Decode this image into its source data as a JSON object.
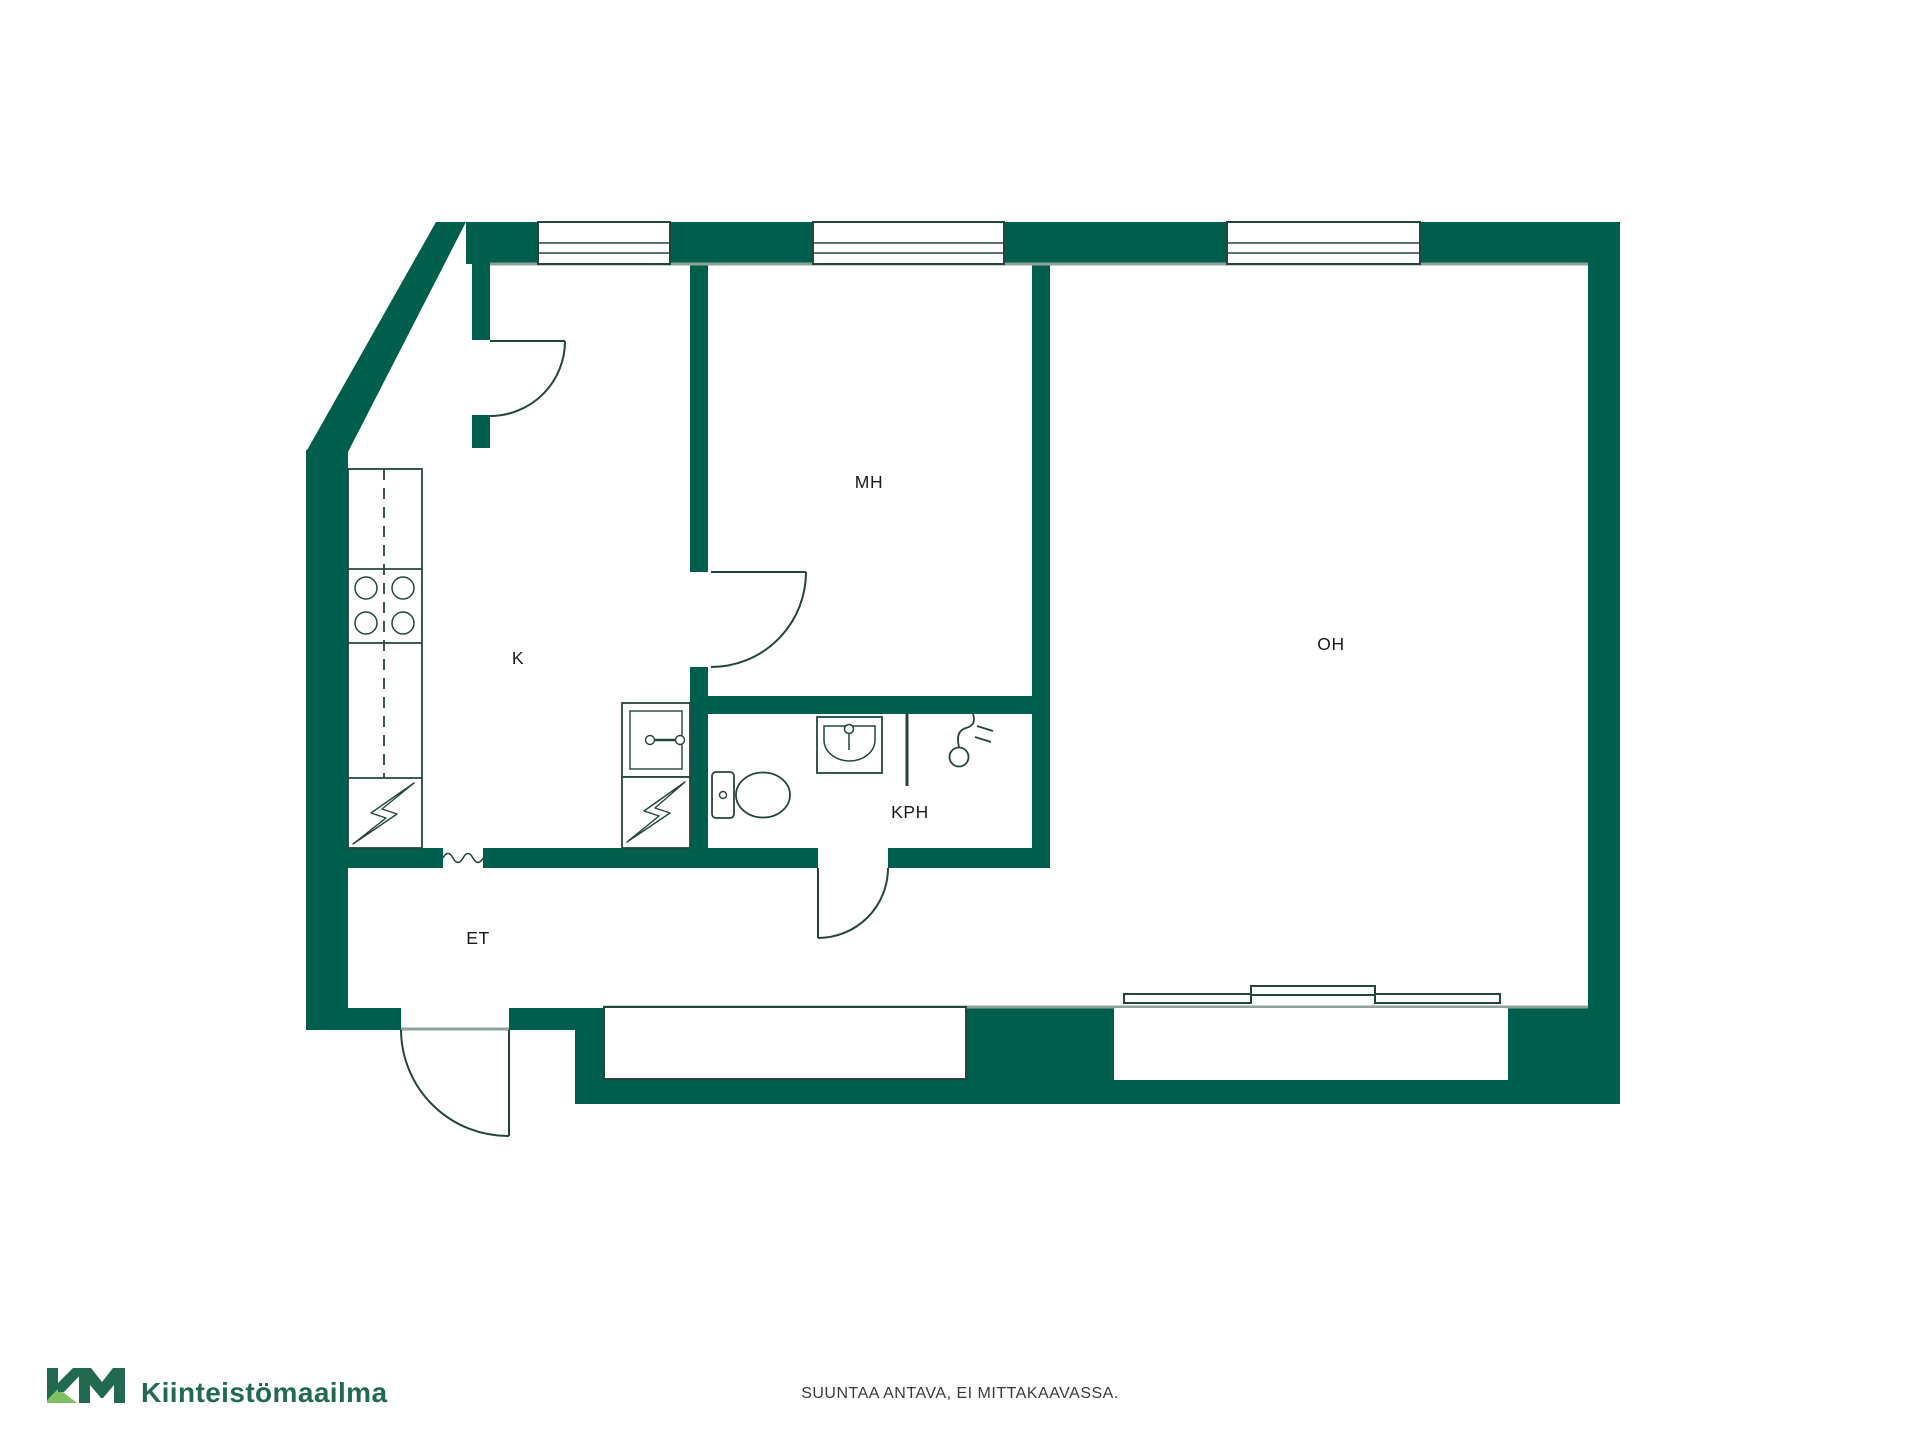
{
  "rooms": {
    "mh": {
      "label": "MH"
    },
    "oh": {
      "label": "OH"
    },
    "k": {
      "label": "K"
    },
    "kph": {
      "label": "KPH"
    },
    "et": {
      "label": "ET"
    }
  },
  "footer": {
    "disclaimer": "SUUNTAA ANTAVA, EI MITTAKAAVASSA."
  },
  "branding": {
    "logo_mark": "KM",
    "logo_text": "Kiinteistömaailma"
  },
  "colors": {
    "wall_green": "#005F4C",
    "outline_dark": "#24453E",
    "floor_line_gray": "#8FA29C",
    "logo_dark_green": "#21694F",
    "logo_light_green": "#7FBF63",
    "label_black": "#1a1a1a"
  },
  "icons": {
    "stove": "stove-burners-icon",
    "fridge_counter": "kitchen-counter-icon",
    "electrical": "lightning-icon",
    "cabinet": "cabinet-handle-icon",
    "toilet": "toilet-icon",
    "washbasin": "washbasin-icon",
    "shower": "shower-icon",
    "shower_rail": "shower-rail-icon",
    "sliding_door": "sliding-door-icon",
    "window": "window-icon",
    "door_swing": "door-swing-icon"
  }
}
